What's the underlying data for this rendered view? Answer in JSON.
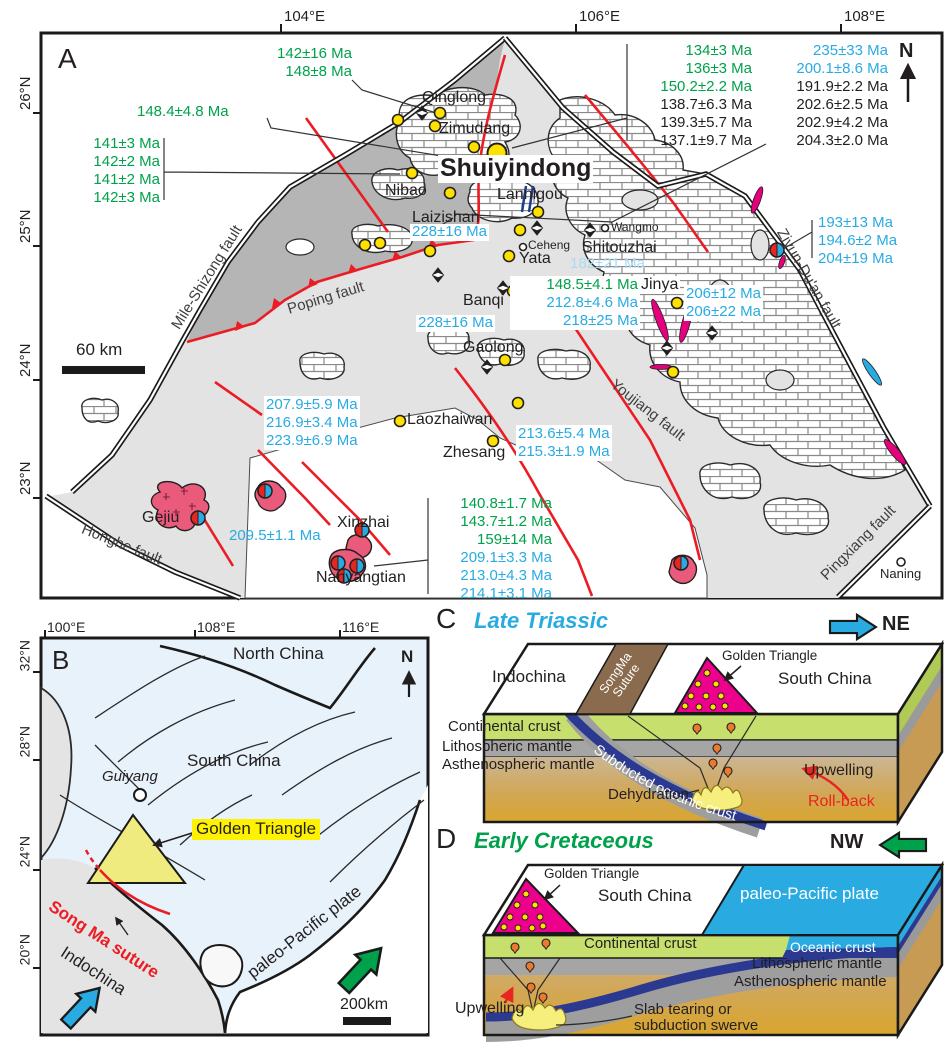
{
  "panelA": {
    "label": "A",
    "compass": "N",
    "scale": "60 km",
    "ticks_top": [
      "104°E",
      "106°E",
      "108°E"
    ],
    "ticks_left": [
      "26°N",
      "25°N",
      "24°N",
      "23°N"
    ],
    "faults": {
      "mile_shizong": "Mile-Shizong fault",
      "poping": "Poping fault",
      "honghe": "Honghe fault",
      "youjiang": "Youjiang fault",
      "ziyun_duan": "Ziyun-Du'an fault",
      "pingxiang": "Pingxiang fault"
    },
    "places": {
      "qinglong": "Qinglong",
      "zimudang": "Zimudang",
      "shuiyindong": "Shuiyindong",
      "nibao": "Nibao",
      "lannigou": "Lannigou",
      "laizishan": "Laizishan",
      "ceheng": "Ceheng",
      "wangmo": "Wangmo",
      "shitouzhai": "Shitouzhai",
      "yata": "Yata",
      "banqi": "Banqi",
      "jinya": "Jinya",
      "gaolong": "Gaolong",
      "laozhaiwan": "Laozhaiwan",
      "zhesang": "Zhesang",
      "gejiu": "Gejiu",
      "xinzhai": "Xinzhai",
      "nanyangtian": "Nanyangtian",
      "naning": "Naning"
    },
    "ages": {
      "nw": [
        "142±16 Ma",
        "148±8 Ma"
      ],
      "nw_single": "148.4±4.8 Ma",
      "west": [
        "141±3 Ma",
        "142±2 Ma",
        "141±2 Ma",
        "142±3 Ma"
      ],
      "ne_col1": [
        "134±3 Ma",
        "136±3 Ma",
        "150.2±2.2 Ma",
        "138.7±6.3 Ma",
        "139.3±5.7 Ma",
        "137.1±9.7 Ma"
      ],
      "ne_col2": [
        "235±33 Ma",
        "200.1±8.6 Ma",
        "191.9±2.2 Ma",
        "202.6±2.5 Ma",
        "202.9±4.2 Ma",
        "204.3±2.0 Ma"
      ],
      "laizishan": "228±16 Ma",
      "shitouzhai": "182±21 Ma",
      "banqi_stack": [
        "148.5±4.1 Ma",
        "212.8±4.6 Ma",
        "218±25 Ma"
      ],
      "banqi_west": "228±16 Ma",
      "jinya": [
        "206±12 Ma",
        "206±22 Ma"
      ],
      "ziyun": [
        "193±13 Ma",
        "194.6±2 Ma",
        "204±19 Ma"
      ],
      "sw": [
        "207.9±5.9 Ma",
        "216.9±3.4 Ma",
        "223.9±6.9 Ma"
      ],
      "zhesang": [
        "213.6±5.4 Ma",
        "215.3±1.9 Ma"
      ],
      "xinzhai": "209.5±1.1 Ma",
      "south": [
        "140.8±1.7 Ma",
        "143.7±1.2 Ma",
        "159±14 Ma",
        "209.1±3.3 Ma",
        "213.0±4.3 Ma",
        "214.1±3.1 Ma"
      ]
    }
  },
  "panelB": {
    "label": "B",
    "compass": "N",
    "scale": "200km",
    "ticks_top": [
      "100°E",
      "108°E",
      "116°E"
    ],
    "ticks_left": [
      "32°N",
      "28°N",
      "24°N",
      "20°N"
    ],
    "labels": {
      "north_china": "North China",
      "south_china": "South China",
      "guiyang": "Guiyang",
      "golden_triangle": "Golden Triangle",
      "song_ma": "Song Ma suture",
      "indochina": "Indochina",
      "paleo_pacific": "paleo-Pacific plate"
    }
  },
  "panelC": {
    "label": "C",
    "title": "Late Triassic",
    "direction": "NE",
    "labels": {
      "indochina": "Indochina",
      "songma_1": "SongMa",
      "songma_2": "Suture",
      "golden_triangle": "Golden Triangle",
      "south_china": "South China",
      "continental_crust": "Continental crust",
      "lithospheric_mantle": "Lithospheric mantle",
      "asthenospheric_mantle": "Asthenospheric mantle",
      "subducted_oceanic_crust": "Subducted oceanic crust",
      "dehydration": "Dehydration",
      "upwelling": "Upwelling",
      "rollback": "Roll-back"
    }
  },
  "panelD": {
    "label": "D",
    "title": "Early Cretaceous",
    "direction": "NW",
    "labels": {
      "golden_triangle": "Golden Triangle",
      "south_china": "South China",
      "paleo_pacific": "paleo-Pacific plate",
      "continental_crust": "Continental crust",
      "oceanic_crust": "Oceanic crust",
      "lithospheric_mantle": "Lithospheric mantle",
      "asthenospheric_mantle": "Asthenospheric mantle",
      "upwelling": "Upwelling",
      "slab_tearing_1": "Slab tearing or",
      "slab_tearing_2": "subduction swerve"
    }
  },
  "colors": {
    "age_green": "#00A14B",
    "age_cyan": "#29ABE2",
    "age_pale_cyan": "#A9DCF2",
    "fault_red": "#EC1C24",
    "dike_magenta": "#E6007E",
    "gold_deposit_yellow": "#FFE100",
    "granite_pink": "#EA5B7B",
    "map_dark_gray": "#B5B5B5",
    "map_light_gray": "#E3E3E3",
    "pale_blue": "#E8F2FA",
    "highlight_yellow": "#FFF200",
    "triangle_magenta": "#EC008C",
    "crust_green": "#C7DF6C",
    "mantle_gray": "#A5A5A5",
    "slab_navy": "#2B3990",
    "pacific_blue": "#29ABE2",
    "suture_brown": "#8A6B4E"
  }
}
